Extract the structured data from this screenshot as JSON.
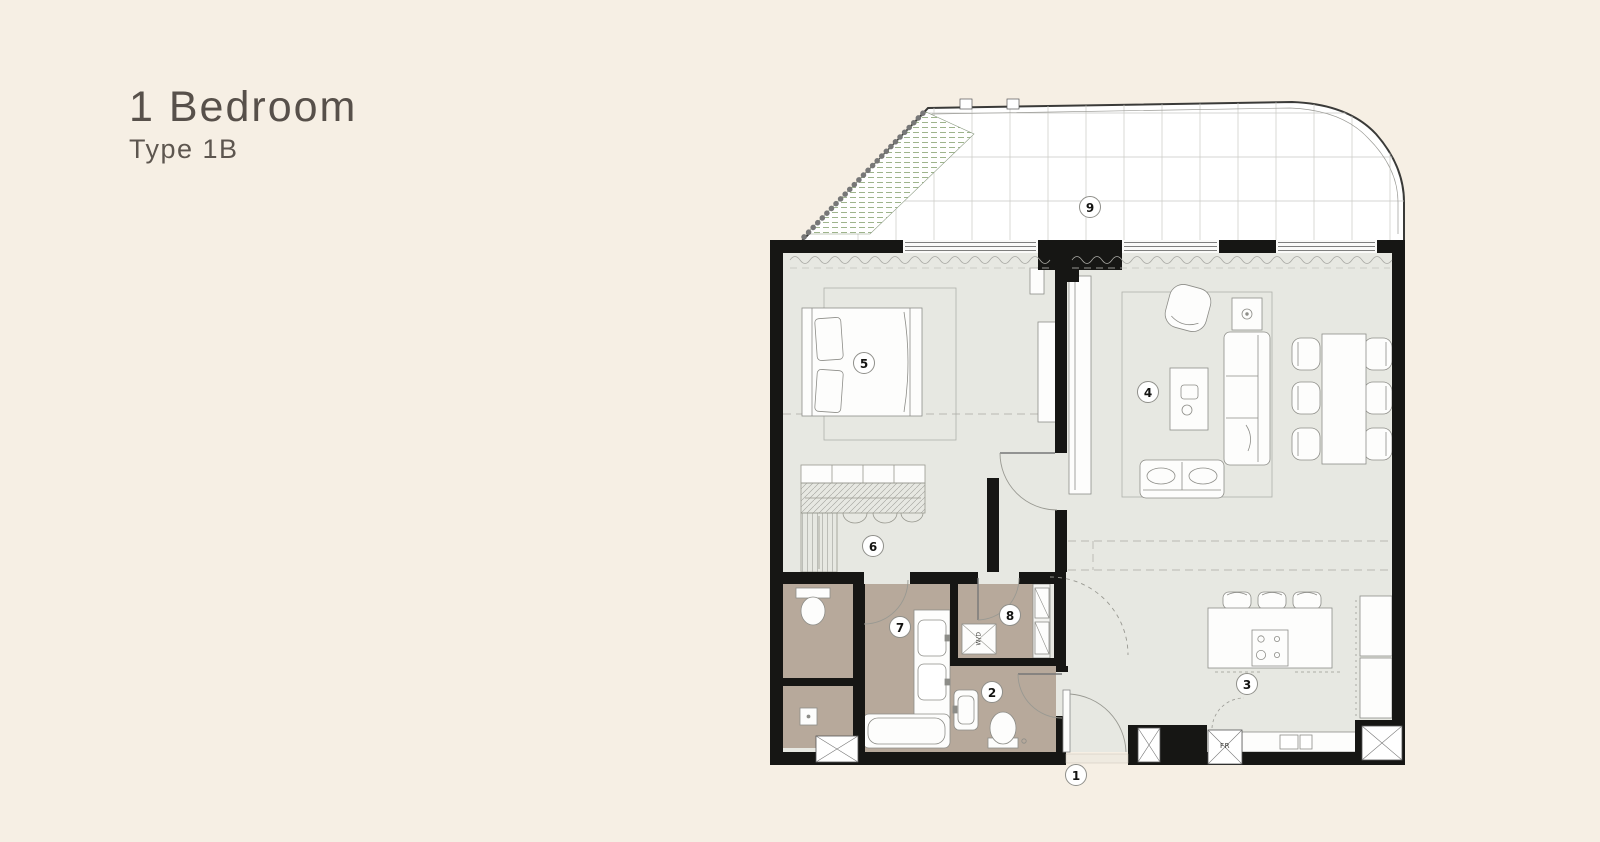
{
  "page": {
    "background": "#f6efe4"
  },
  "title": {
    "heading": "1 Bedroom",
    "subheading": "Type 1B",
    "text_color": "#57504a"
  },
  "floorplan": {
    "markers": [
      {
        "label": "1"
      },
      {
        "label": "2"
      },
      {
        "label": "3"
      },
      {
        "label": "4"
      },
      {
        "label": "5"
      },
      {
        "label": "6"
      },
      {
        "label": "7"
      },
      {
        "label": "8"
      },
      {
        "label": "9"
      }
    ],
    "labels": {
      "fridge": "FR",
      "washer_dryer": "W/D"
    },
    "colors": {
      "wall": "#161614",
      "floor": "#e7e8e2",
      "wet_rooms": "#b7a99b",
      "balcony": "#ffffff",
      "planter_hatch": "#9eb48c",
      "furniture_outline": "#8d8d88"
    }
  }
}
